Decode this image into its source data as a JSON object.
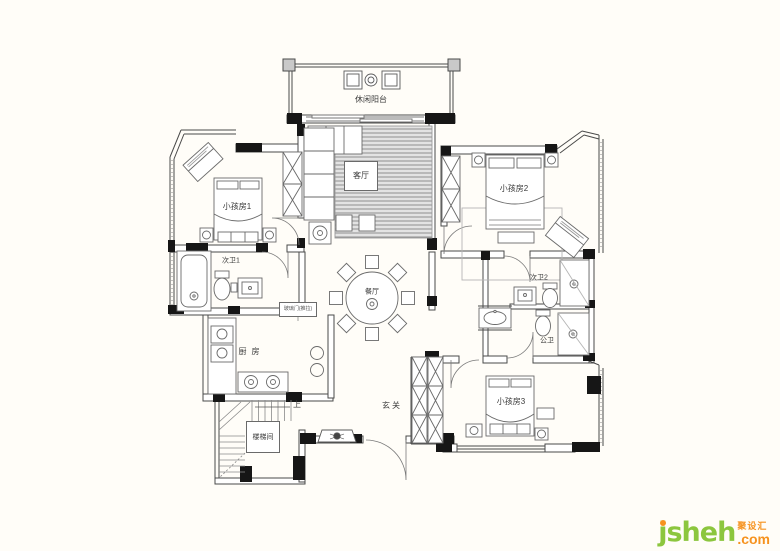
{
  "plan": {
    "rooms": {
      "balcony": "休闲阳台",
      "living": "客厅",
      "kids1": "小孩房1",
      "bath1": "次卫1",
      "kitchen": "厨房",
      "stairs": "楼梯间",
      "up": "上",
      "entry": "玄关",
      "dining": "餐厅",
      "kids2": "小孩房2",
      "bath2": "次卫2",
      "public_bath": "公卫",
      "kids3": "小孩房3",
      "door_note": "玻璃门(推拉)"
    }
  },
  "logo": {
    "name": "jsheh",
    "tld": ".com",
    "cn": "聚设汇"
  },
  "colors": {
    "background": "#fffdf8",
    "wall_fill": "#161616",
    "line": "#3f3f3f",
    "rug_stripe": "#8f8f8f",
    "logo_green": "#8cc63e",
    "logo_orange": "#f6921e"
  }
}
